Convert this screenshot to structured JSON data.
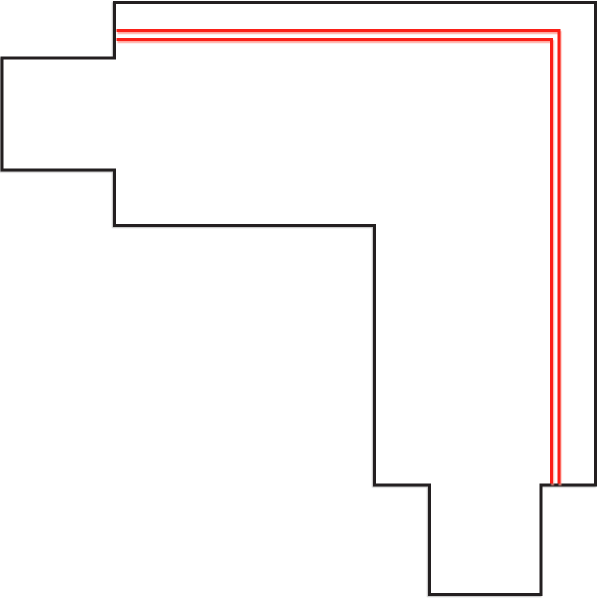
{
  "canvas": {
    "width": 600,
    "height": 600,
    "background_color": "#ffffff"
  },
  "diagram": {
    "type": "technical-line-drawing",
    "outline": {
      "shape": "corner-profile-polygon",
      "stroke_color": "#231f20",
      "stroke_width": 3,
      "fill_color": "#ffffff",
      "shadow_color": "#bdbdbd",
      "points": [
        [
          114.5,
          2.5
        ],
        [
          595.5,
          2.5
        ],
        [
          595.5,
          485
        ],
        [
          541,
          485
        ],
        [
          541,
          594.5
        ],
        [
          429.5,
          594.5
        ],
        [
          429.5,
          485
        ],
        [
          374.5,
          485
        ],
        [
          374.5,
          225.5
        ],
        [
          114.5,
          225.5
        ],
        [
          114.5,
          170
        ],
        [
          2,
          170
        ],
        [
          2,
          58
        ],
        [
          114.5,
          58
        ]
      ]
    },
    "conductor_lines": {
      "stroke_color": "#fb2018",
      "stroke_width": 3,
      "shadow_color": "#ff9d94",
      "outer": {
        "points": [
          [
            116.5,
            30.5
          ],
          [
            559,
            30.5
          ],
          [
            559,
            483.5
          ]
        ]
      },
      "inner": {
        "points": [
          [
            116.5,
            39.5
          ],
          [
            551.5,
            39.5
          ],
          [
            551.5,
            483.5
          ]
        ]
      }
    }
  }
}
